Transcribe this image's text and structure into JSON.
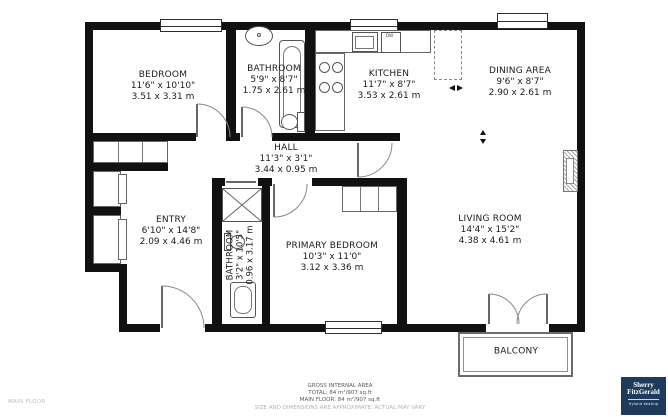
{
  "plan": {
    "rooms": [
      {
        "name": "BEDROOM",
        "imperial": "11'6\" x 10'10\"",
        "metric": "3.51 x 3.31 m"
      },
      {
        "name": "BATHROOM",
        "imperial": "5'9\" x 8'7\"",
        "metric": "1.75 x 2.61 m"
      },
      {
        "name": "KITCHEN",
        "imperial": "11'7\" x 8'7\"",
        "metric": "3.53 x 2.61 m"
      },
      {
        "name": "DINING AREA",
        "imperial": "9'6\" x 8'7\"",
        "metric": "2.90 x 2.61 m"
      },
      {
        "name": "HALL",
        "imperial": "11'3\" x 3'1\"",
        "metric": "3.44 x 0.95 m"
      },
      {
        "name": "ENTRY",
        "imperial": "6'10\" x 14'8\"",
        "metric": "2.09 x 4.46 m"
      },
      {
        "name": "BATHROOM",
        "imperial": "3'2\" x 10'5\"",
        "metric": "0.96 x 3.17 m"
      },
      {
        "name": "PRIMARY BEDROOM",
        "imperial": "10'3\" x 11'0\"",
        "metric": "3.12 x 3.36 m"
      },
      {
        "name": "LIVING ROOM",
        "imperial": "14'4\" x 15'2\"",
        "metric": "4.38 x 4.61 m"
      },
      {
        "name": "BALCONY",
        "imperial": "",
        "metric": ""
      }
    ],
    "appliances": {
      "dishwasher": "DW"
    }
  },
  "footer": {
    "floor_label": "MAIN FLOOR",
    "area_title": "GROSS INTERNAL AREA",
    "total": "TOTAL: 84 m²/907 sq.ft",
    "main_floor": "MAIN FLOOR: 84 m²/907 sq.ft",
    "disclaimer": "SIZE AND DIMENSIONS ARE APPROXIMATE, ACTUAL MAY VARY"
  },
  "branding": {
    "line1": "Sherry",
    "line2": "FitzGerald",
    "sub": "Hyland Keating",
    "color": "#1e3a5c"
  }
}
